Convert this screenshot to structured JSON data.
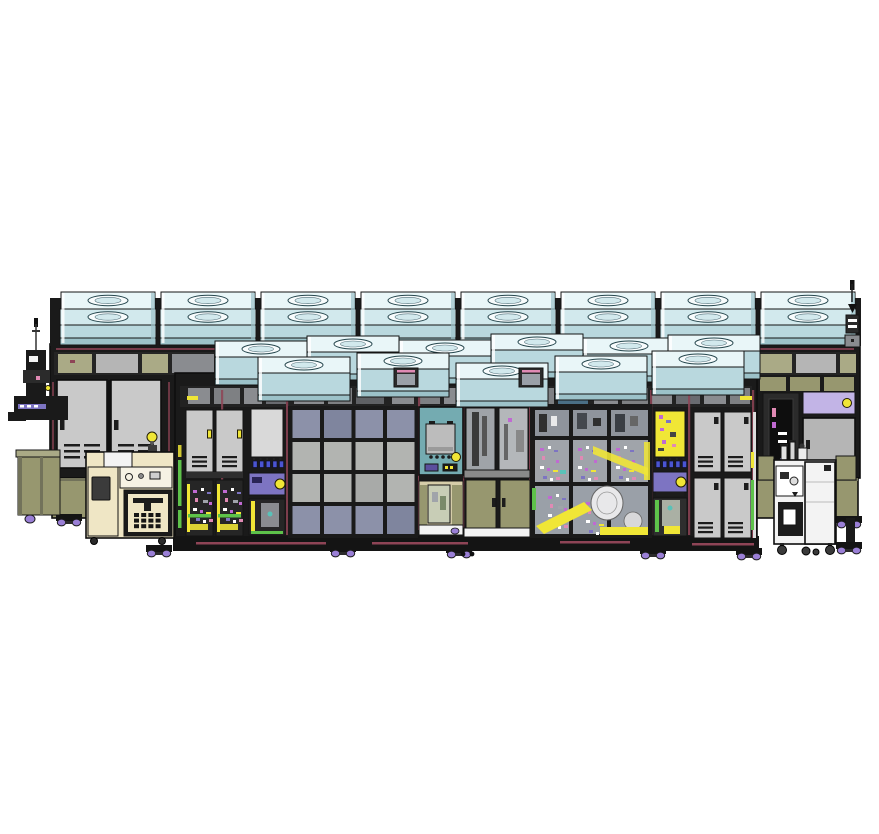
{
  "colors": {
    "frame": "#1a1a1a",
    "frame2": "#2b2b2b",
    "frame3": "#3a3a3a",
    "ffu_top": "#e9f6f8",
    "ffu_mid": "#d2e9ed",
    "ffu_face": "#b9d8de",
    "ffu_side": "#9cc2c9",
    "ffu_ring": "#f8fcfd",
    "panel_gray": "#c9c9c9",
    "panel_gray2": "#b5b5b5",
    "panel_dark": "#8a8c90",
    "panel_mid": "#9a9ca0",
    "glass_blue": "#8c91a9",
    "glass_gray": "#b2b4b1",
    "gray_int": "#a0a4aa",
    "olive": "#97976f",
    "olive_light": "#aaaa86",
    "olive_dark": "#72725a",
    "teal": "#74abb1",
    "beige": "#efe6c5",
    "beige_dark": "#d6cda9",
    "lavender": "#c2b4e6",
    "purple": "#7d74c2",
    "purple_deep": "#5a4f9e",
    "magenta": "#c06ad2",
    "pink": "#e08ab4",
    "maroon": "#8e4456",
    "yellow": "#f0e636",
    "green": "#5ec24a",
    "blue_led": "#4a55d2",
    "white": "#ffffff",
    "near_white": "#f3f3f3",
    "violet_foot": "#9a7fd6",
    "blue_glass": "#4a6f86"
  },
  "machine": {
    "ffu_back_row_count": 8,
    "ffu_middle_row_count": 6,
    "ffu_front_row_count": 5,
    "yellow_indicator_count": 5,
    "blue_led_strip_count": 2,
    "center_glass_grid": "4x4",
    "right_locker_door_count": 4,
    "service_cart_count": 2,
    "signal_antenna_count": 2
  }
}
